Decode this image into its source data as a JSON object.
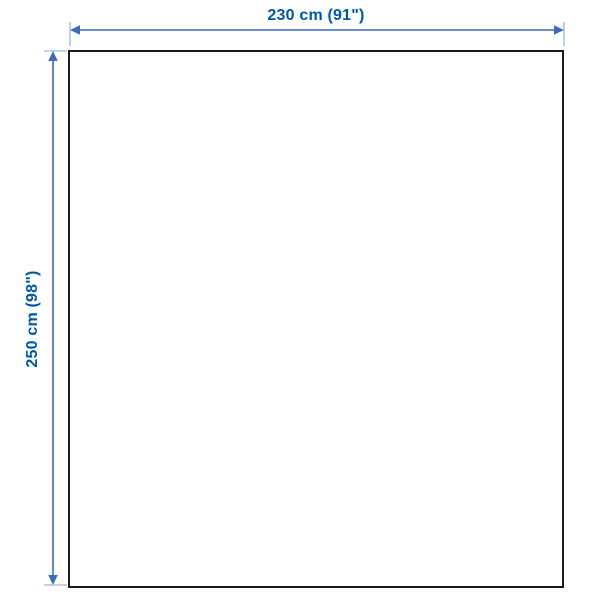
{
  "diagram": {
    "type": "product-dimension-diagram",
    "width_label": "230 cm (91\")",
    "height_label": "250 cm (98\")"
  },
  "colors": {
    "label": "#0058a3",
    "line": "#3d6cb4",
    "tick": "#a9c3e4",
    "outline": "#1a1a1a",
    "background": "#ffffff"
  }
}
